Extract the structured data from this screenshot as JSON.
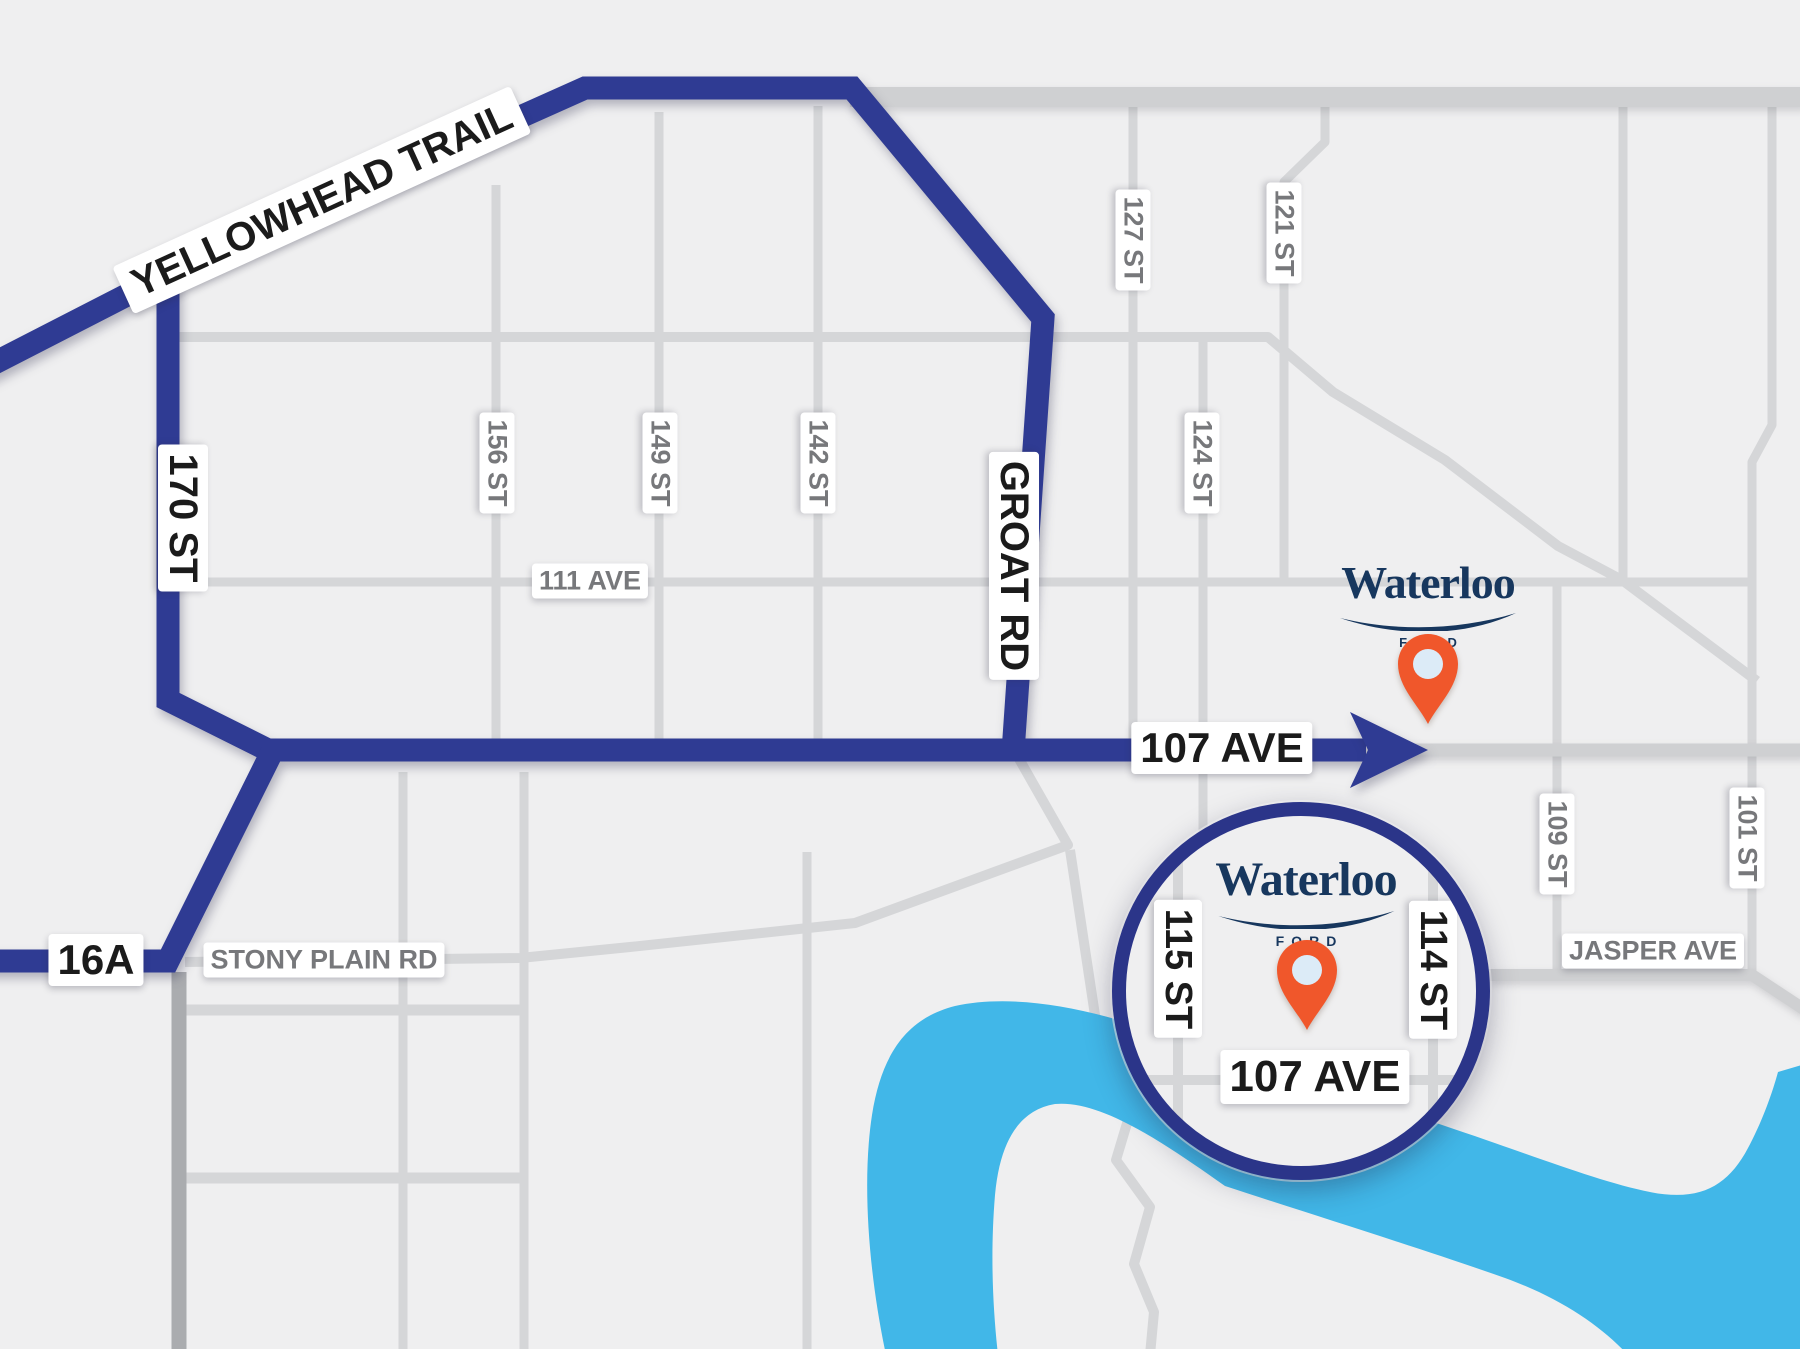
{
  "map_title": "Waterloo Ford directions map",
  "colors": {
    "route": "#2F3B93",
    "ring": "#2B3589",
    "river": "#41B7E8",
    "road": "#D5D6D8",
    "road_medium": "#CFD0D2",
    "road_dark": "#AAACAF",
    "background": "#EFEFF0",
    "label_black": "#1B1B1B",
    "label_gray": "#77787B",
    "logo_navy": "#17375E",
    "pin_orange": "#F0572B",
    "pin_hole": "#DCEBF7"
  },
  "route_labels": {
    "yellowhead_trail": "YELLOWHEAD TRAIL",
    "st_170": "170 ST",
    "groat_rd": "GROAT RD",
    "ave_107": "107 AVE",
    "hwy_16a": "16A"
  },
  "street_labels": {
    "st_156": "156 ST",
    "st_149": "149 ST",
    "st_142": "142 ST",
    "st_127": "127 ST",
    "st_121": "121 ST",
    "st_124": "124 ST",
    "ave_111": "111 AVE",
    "stony_plain_rd": "STONY PLAIN RD",
    "st_109": "109 ST",
    "st_101": "101 ST",
    "jasper_ave": "JASPER AVE"
  },
  "dealer": {
    "name": "Waterloo",
    "brand": "FORD"
  },
  "inset": {
    "dealer_name": "Waterloo",
    "dealer_brand": "FORD",
    "st_115": "115 ST",
    "st_114": "114 ST",
    "ave_107": "107 AVE"
  }
}
